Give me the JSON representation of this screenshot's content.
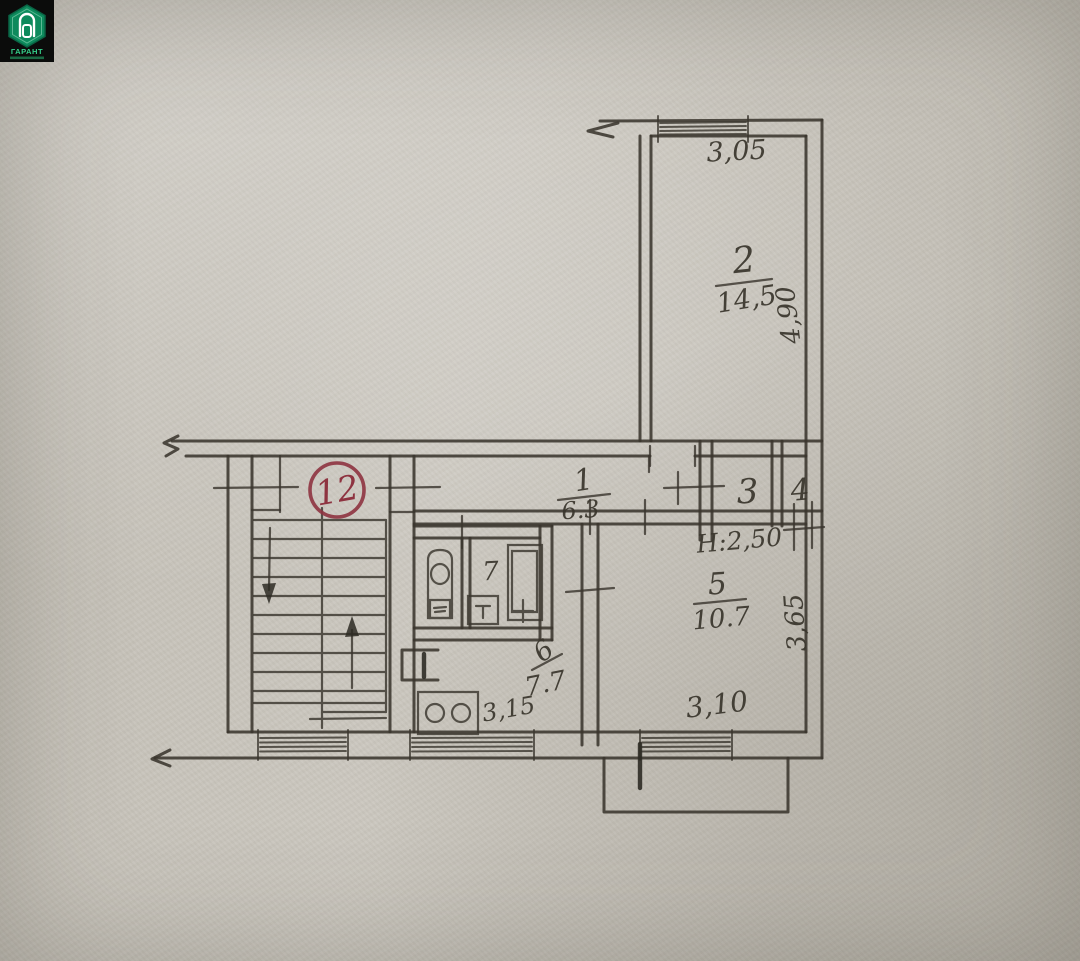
{
  "plan": {
    "apartment_number": "12",
    "height_note": "Н:2,50",
    "rooms": [
      {
        "number": "1",
        "area": "6.3"
      },
      {
        "number": "2",
        "area": "14,5"
      },
      {
        "number": "3",
        "area": ""
      },
      {
        "number": "4",
        "area": ""
      },
      {
        "number": "5",
        "area": "10.7"
      },
      {
        "number": "6",
        "area": "7.7"
      },
      {
        "number": "7",
        "area": ""
      }
    ],
    "dimensions": {
      "room2_width": "3,05",
      "room2_depth": "4,90",
      "room5_width": "3,10",
      "room5_depth": "3,65",
      "kitchen_width": "3,15"
    },
    "colors": {
      "ink": "#3a362e",
      "paper": "#c8c4bb",
      "stamp_red": "#8e3340",
      "logo_green": "#35d08a"
    }
  },
  "watermark": {
    "brand": "ГАРАНТ"
  }
}
